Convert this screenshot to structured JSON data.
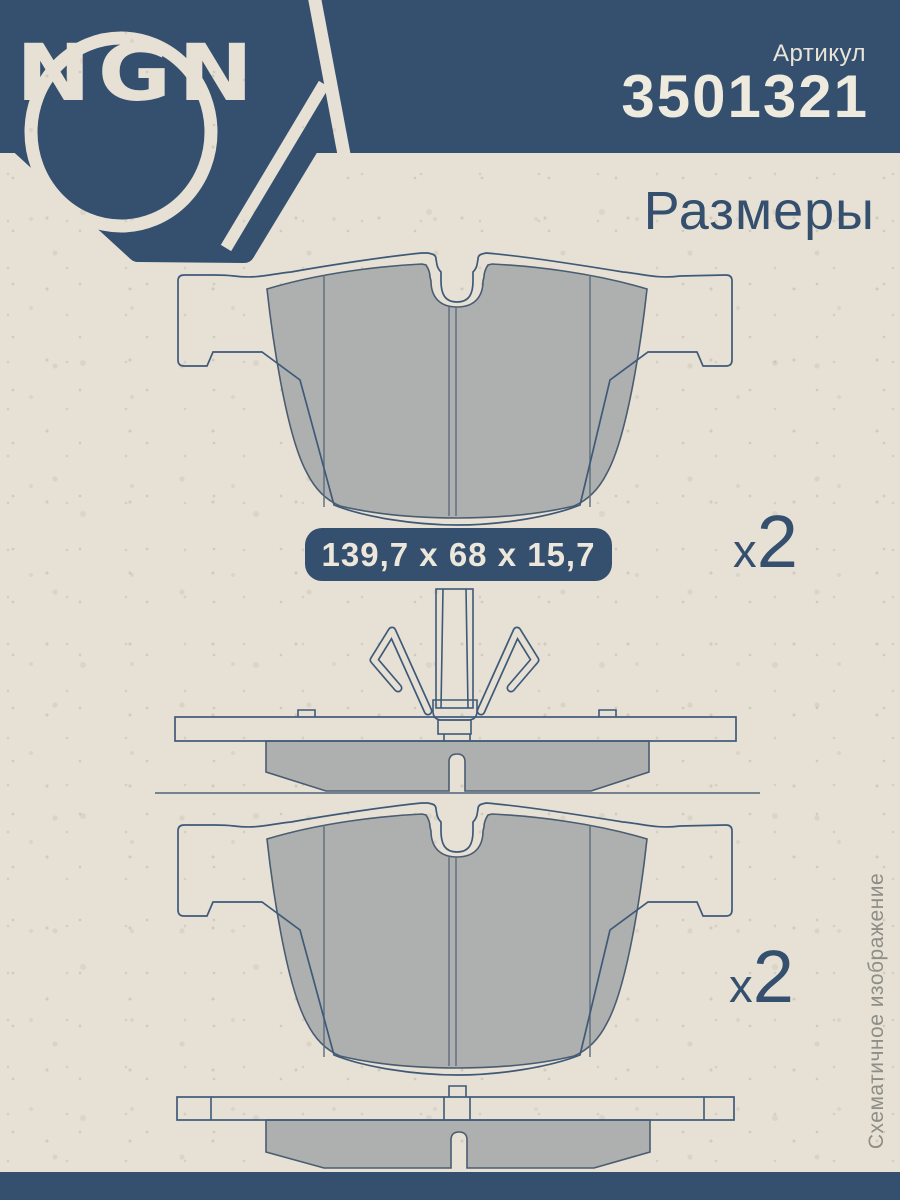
{
  "colors": {
    "accent_blue": "#35506e",
    "cream_text": "#ece7da",
    "pad_gray": "#aeb0af",
    "outline_blue": "#3f5a78",
    "note_gray": "#8e8e87",
    "paper": "#e7e1d5",
    "divider": "#75828f"
  },
  "header": {
    "logo_text": "NGN",
    "article_label": "Артикул",
    "article_number": "3501321"
  },
  "section_title": "Размеры",
  "dimensions": {
    "badge": "139,7 x 68 x 15,7"
  },
  "quantity_top": {
    "prefix": "x",
    "value": "2"
  },
  "quantity_bottom": {
    "prefix": "x",
    "value": "2"
  },
  "note": {
    "text": "Схематичное изображение"
  }
}
